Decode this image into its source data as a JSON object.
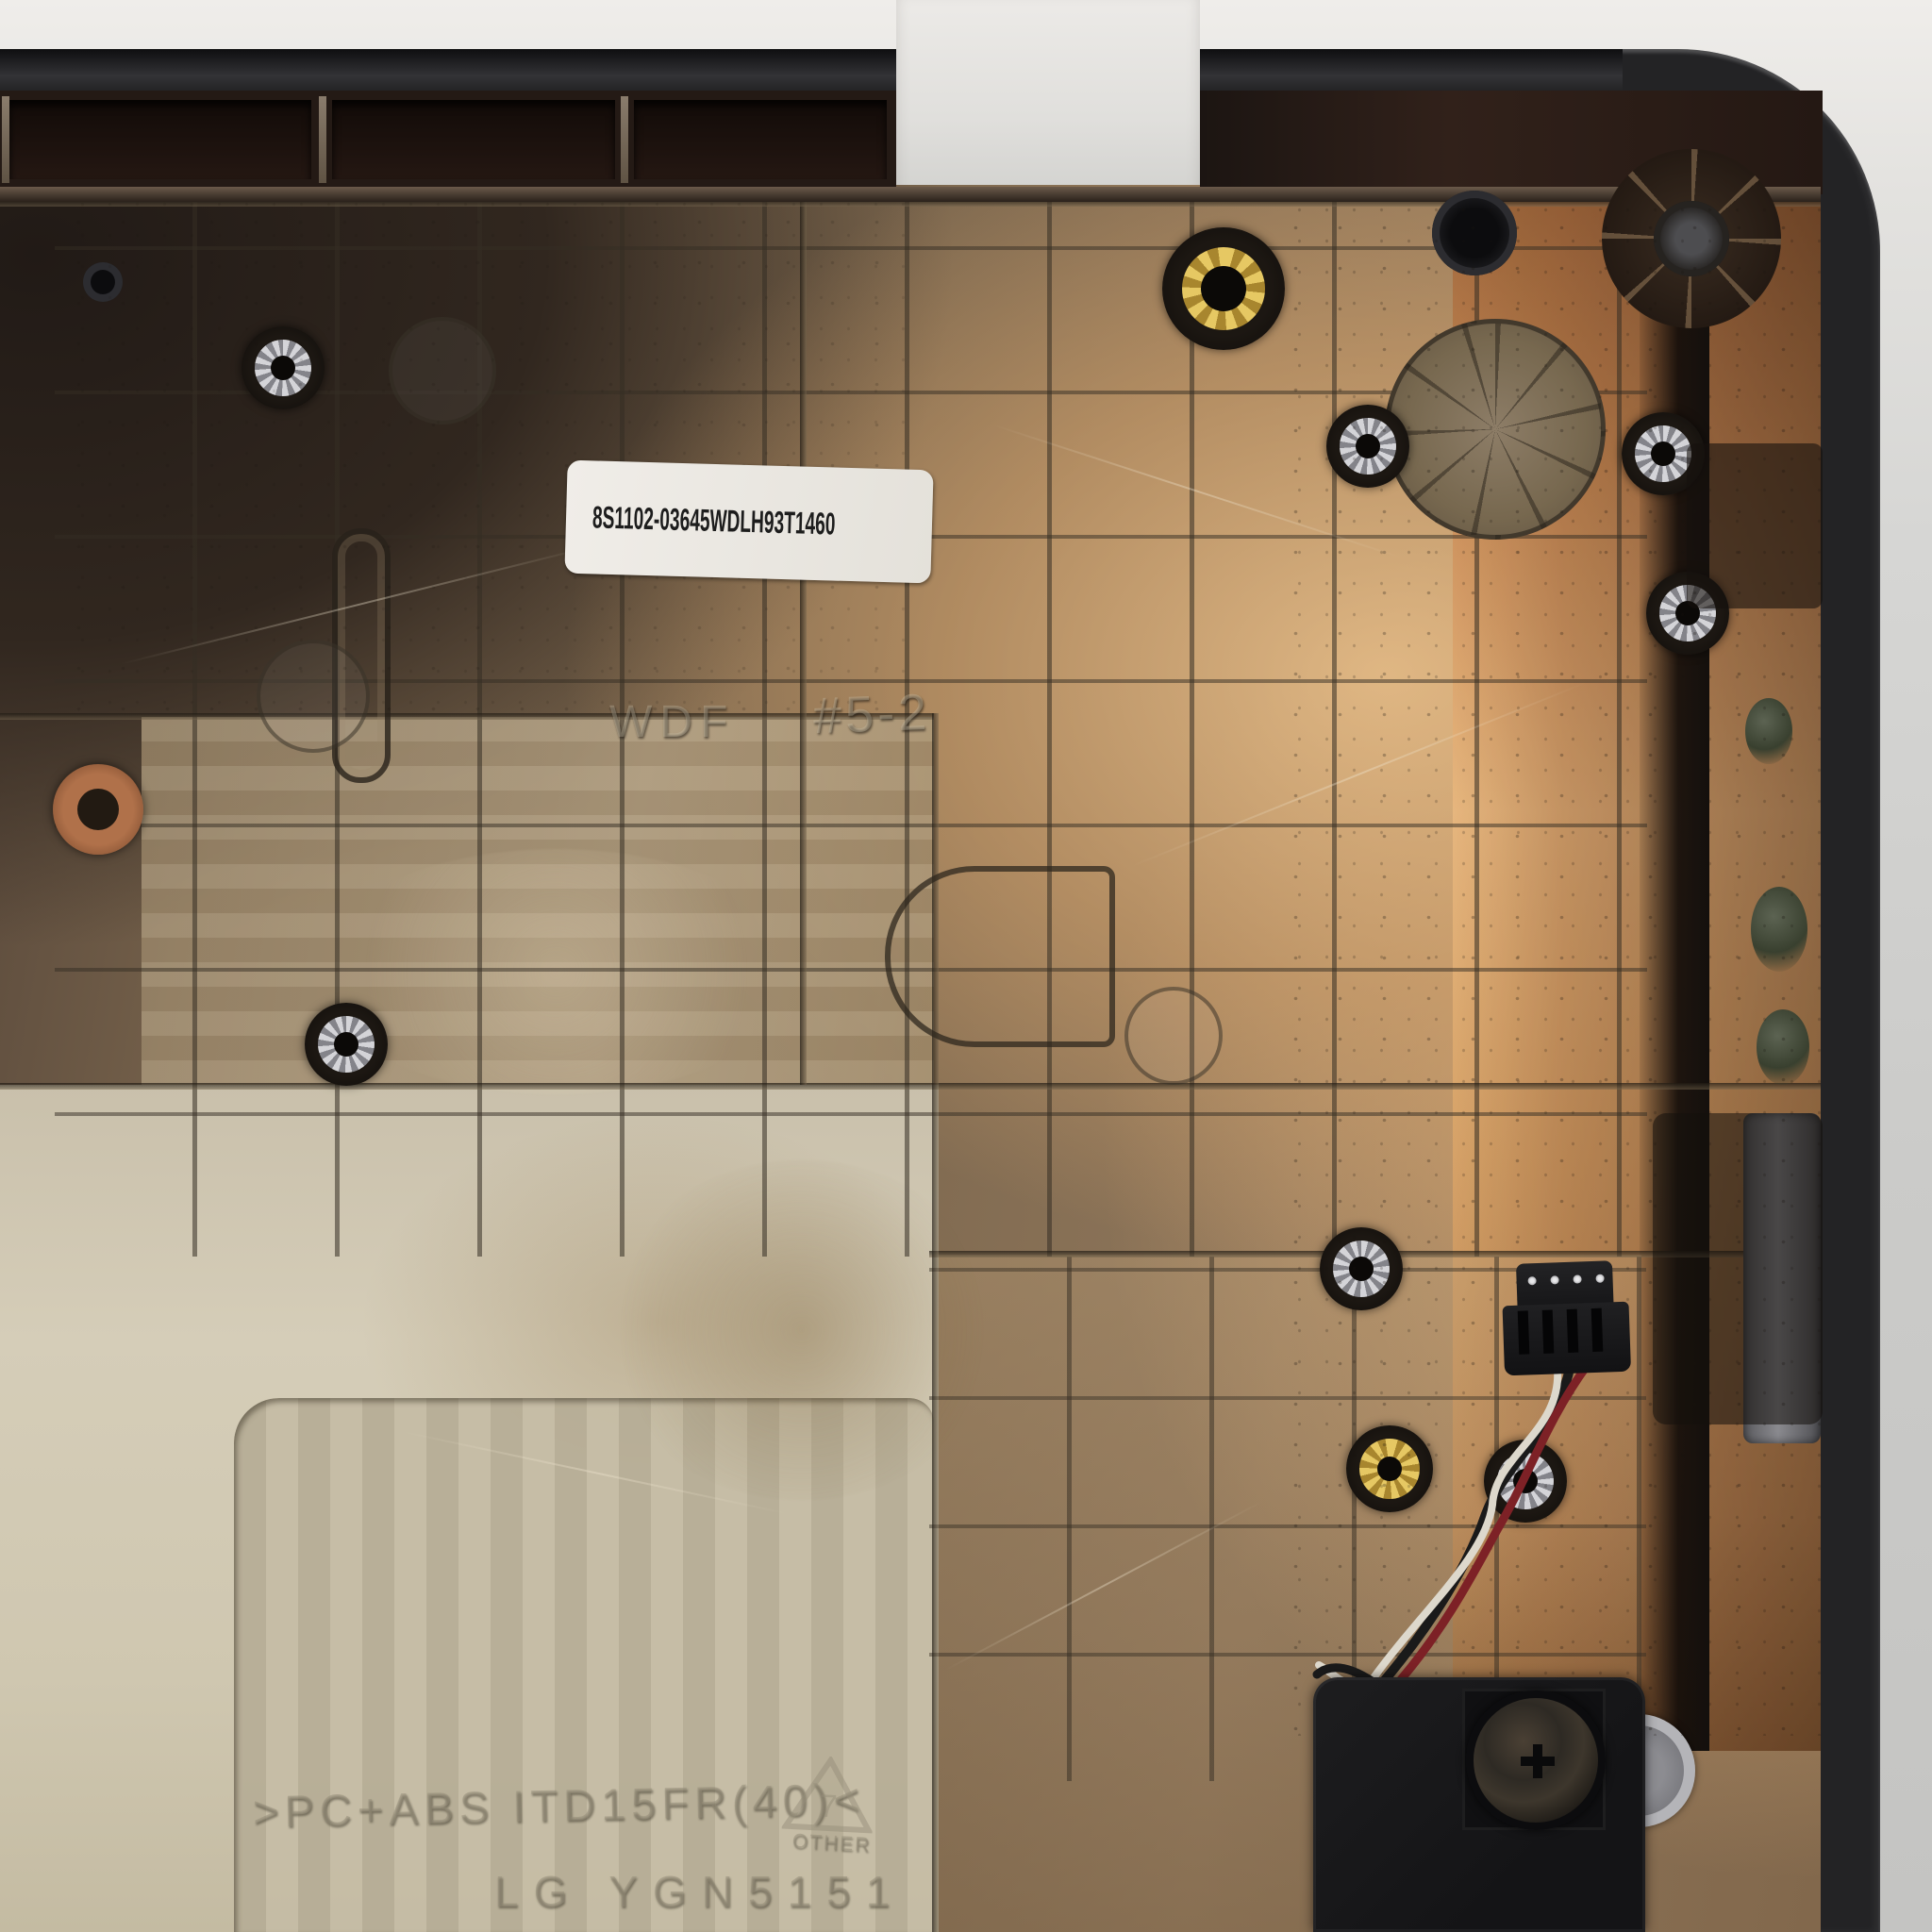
{
  "part": {
    "label": {
      "barcode_text": "8S1102-03645WDLH93T1460",
      "qr_icon": "qr-code"
    },
    "mold_markings": {
      "tool": "WDF",
      "cavity": "#5-2",
      "material": ">PC+ABS ITD15FR(40)<",
      "recycle_code": "7",
      "recycle_label": "OTHER",
      "maker": "LG YGN5151"
    }
  },
  "colors": {
    "backdrop": "#d8d8d6",
    "case_black": "#232325",
    "copper_stain": "#e9b87f",
    "bronze_interior": "#8f765a",
    "beige_panel": "#d5cdb8",
    "label_background": "#ece9e4",
    "brass_insert": "#e6c863",
    "washer_silver": "#d4d4d8",
    "wire_red": "#7d2126",
    "wire_white": "#ddd8cc",
    "wire_black": "#1a1a1a"
  }
}
